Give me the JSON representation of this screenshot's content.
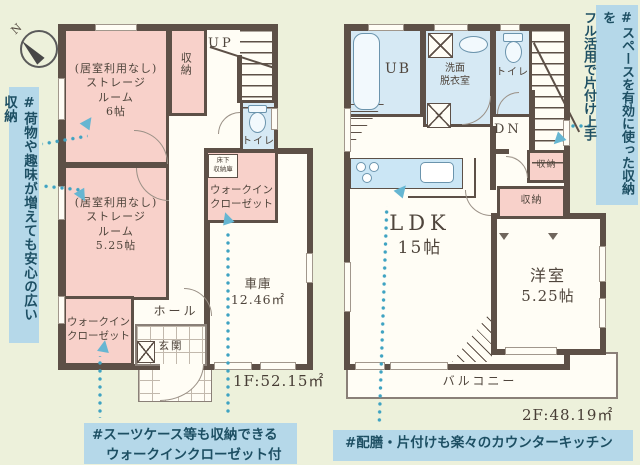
{
  "colors": {
    "bg": "#edf1db",
    "floor": "#fffdf5",
    "wall": "#5d5047",
    "pink": "#f8d1ca",
    "blue": "#d6e9f4",
    "counter": "#cbe6f5",
    "notebg": "#b5d8e9",
    "notetext": "#1d4f63",
    "label": "#4f453c",
    "teal": "#3fa3c2"
  },
  "compass": {
    "north": "N"
  },
  "f1": {
    "area": "1F:52.15㎡",
    "up": "UP",
    "storage6": {
      "l1": "(居室利用なし)",
      "l2": "ストレージ",
      "l3": "ルーム",
      "l4": "6帖"
    },
    "storage525": {
      "l1": "(居室利用なし)",
      "l2": "ストレージ",
      "l3": "ルーム",
      "l4": "5.25帖"
    },
    "closet": "収納",
    "toilet": "トイレ",
    "underfloor": {
      "l1": "床下",
      "l2": "収納庫"
    },
    "wic_upper": {
      "l1": "ウォークイン",
      "l2": "クローゼット"
    },
    "wic_lower": {
      "l1": "ウォークイン",
      "l2": "クローゼット"
    },
    "hall": "ホール",
    "entrance": "玄関",
    "garage": {
      "l1": "車庫",
      "l2": "12.46㎡"
    }
  },
  "f2": {
    "area": "2F:48.19㎡",
    "ub": "UB",
    "washroom": {
      "l1": "洗面",
      "l2": "脱衣室"
    },
    "toilet": "トイレ",
    "dn": "DN",
    "closet_a": "収納",
    "closet_b": "収納",
    "ldk": {
      "l1": "LDK",
      "l2": "15帖"
    },
    "western": {
      "l1": "洋室",
      "l2": "5.25帖"
    },
    "balcony": "バルコニー"
  },
  "notes": {
    "left": "#荷物や趣味が増えても安心の広い収納",
    "right_l1": "#スペースを有効に使った収納を",
    "right_l2": "フル活用で片付け上手",
    "bottom_left_l1": "#スーツケース等も収納できる",
    "bottom_left_l2": "ウォークインクローゼット付",
    "bottom_right": "#配膳・片付けも楽々のカウンターキッチン"
  }
}
